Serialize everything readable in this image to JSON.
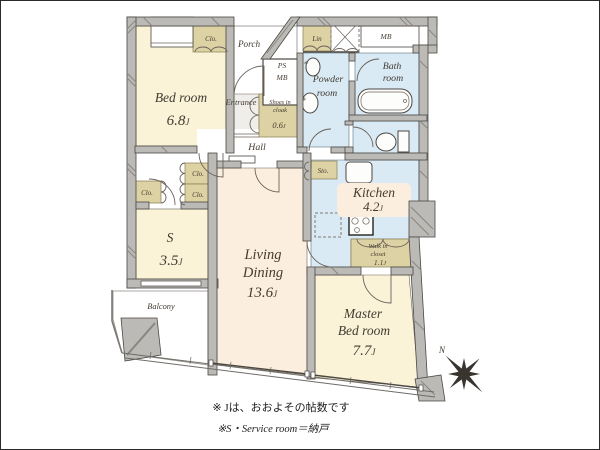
{
  "palette": {
    "room_cream": "#faf3d8",
    "room_peach": "#fbeede",
    "wet_blue": "#d9eaf5",
    "closet_tan": "#ddd2a3",
    "wall_gray": "#bbbab7",
    "text_brown": "#433b31"
  },
  "rooms": {
    "bedroom": {
      "name": "Bed room",
      "num": "6.8",
      "unit": "J"
    },
    "service": {
      "name": "S",
      "num": "3.5",
      "unit": "J"
    },
    "living": {
      "line1": "Living",
      "line2": "Dining",
      "num": "13.6",
      "unit": "J"
    },
    "master": {
      "line1": "Master",
      "line2": "Bed room",
      "num": "7.7",
      "unit": "J"
    },
    "kitchen": {
      "name": "Kitchen",
      "num": "4.2",
      "unit": "J"
    },
    "shoes_closet": {
      "line1": "Shoes in",
      "line2": "cloak",
      "num": "0.6",
      "unit": "J"
    },
    "walkin_closet": {
      "line1": "Walk in",
      "line2": "closet",
      "num": "1.1",
      "unit": "J"
    }
  },
  "labels": {
    "porch": "Porch",
    "entrance": "Entrance",
    "hall": "Hall",
    "powder_line1": "Powder",
    "powder_line2": "room",
    "bath_line1": "Bath",
    "bath_line2": "room",
    "balcony": "Balcony",
    "closet": "Clo.",
    "linen": "Lin",
    "storage": "Sto.",
    "ps": "PS",
    "mb": "MB",
    "meter_box": "MB",
    "north": "N"
  },
  "notes": {
    "line1": "※ Jは、おおよその帖数です",
    "line2": "※S・Service room＝納戸"
  }
}
